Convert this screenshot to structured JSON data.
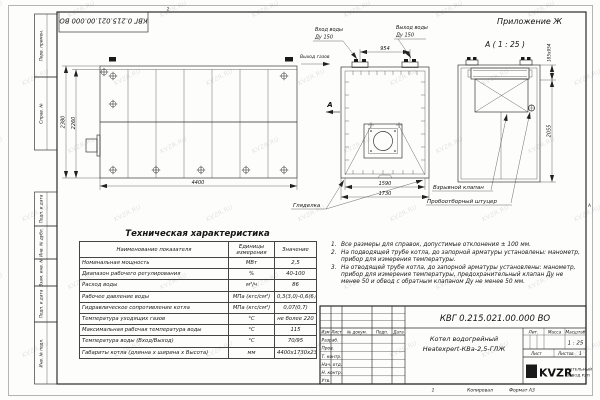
{
  "frame": {
    "appendix_label": "Приложение Ж",
    "doc_number_rotated": "КВГ 0.215.021.00.000 ВО",
    "zone_top": "2",
    "zone_right": "А",
    "zone_bottom": "1",
    "margin_labels": [
      "Перв. примен.",
      "Справ. №",
      "Подп. и дата",
      "Инв. № дубл.",
      "Взам. инв. №",
      "Подп. и дата",
      "Инв. № подл."
    ]
  },
  "watermark": {
    "text": "KVZR.RU"
  },
  "side_view": {
    "dim_height_overall": "2380",
    "dim_height_body": "2260",
    "dim_length": "4400",
    "sight_glass_label": "Гляделка"
  },
  "front_view": {
    "water_inlet_label": "Вход воды",
    "water_inlet_dn": "Ду 150",
    "water_outlet_label": "Выход воды",
    "water_outlet_dn": "Ду 150",
    "gas_outlet_label": "Выход газов",
    "dim_nozzle_spacing": "954",
    "dim_width_body": "1590",
    "dim_width_overall": "1730",
    "view_arrow_letter": "А"
  },
  "detail_view": {
    "title": "А ( 1 : 25 )",
    "dim_valve": "185х954",
    "dim_height": "2055",
    "explosion_valve_label": "Взрывной клапан",
    "sampling_fitting_label": "Пробоотборный штуцер"
  },
  "notes": [
    {
      "num": "1.",
      "text": "Все размеры для справок, допустимые отклонения ± 100 мм."
    },
    {
      "num": "2.",
      "text": "На подводящей трубе котла, до запорной арматуры установлены: манометр, прибор для измерения температуры."
    },
    {
      "num": "3.",
      "text": "На отводящей трубе котла, до запорной арматуры установлены: манометр, прибор для измерения температуры, предохранительный клапан Ду не менее 50 и обвод с обратным клапаном Ду не менее 50 мм."
    }
  ],
  "tech_table": {
    "title": "Техническая характеристика",
    "headers": [
      "Наименование показателя",
      "Единицы измерения",
      "Значение"
    ],
    "rows": [
      {
        "name": "Номинальная мощность",
        "unit": "МВт",
        "value": "2,5"
      },
      {
        "name": "Диапазон рабочего регулирования",
        "unit": "%",
        "value": "40-100"
      },
      {
        "name": "Расход воды",
        "unit": "м³/ч",
        "value": "86"
      },
      {
        "name": "Рабочее давление воды",
        "unit": "МПа (кгс/см²)",
        "value": "0,3(3,0)-0,6(6,0)"
      },
      {
        "name": "Гидравлическое сопротивление котла",
        "unit": "МПа (кгс/см²)",
        "value": "0,07(0,7)"
      },
      {
        "name": "Температура уходящих газов",
        "unit": "°С",
        "value": "не более 220"
      },
      {
        "name": "Максимальная рабочая температура воды",
        "unit": "°С",
        "value": "115"
      },
      {
        "name": "Температура воды (Вход/Выход)",
        "unit": "°С",
        "value": "70/95"
      },
      {
        "name": "Габариты котла (длинна х ширина х Высота)",
        "unit": "мм",
        "value": "4400х1730х2380"
      }
    ]
  },
  "title_block": {
    "doc_number": "КВГ 0.215.021.00.000 ВО",
    "product_name_line1": "Котел водогрейный",
    "product_name_line2": "Heatexpert-КВа-2,5-ГЛЖ",
    "rev_headers": [
      "Изм",
      "Лист",
      "№ докум.",
      "Подп.",
      "Дата"
    ],
    "sig_rows": [
      "Разраб.",
      "Пров.",
      "Т. контр.",
      "Нач. отд.",
      "Н. контр.",
      "Утв."
    ],
    "lit_label": "Лит.",
    "mass_label": "Масса",
    "scale_label": "Масштаб",
    "scale_value": "1 : 25",
    "sheet_label": "Лист",
    "sheets_label": "Листов",
    "sheets_value": "1",
    "logo_text": "KVZR",
    "company_line1": "КОТЕЛЬНЫЙ",
    "company_line2": "ЗАВОД РЭП",
    "copied_label": "Копировал",
    "format_label": "Формат А3"
  }
}
